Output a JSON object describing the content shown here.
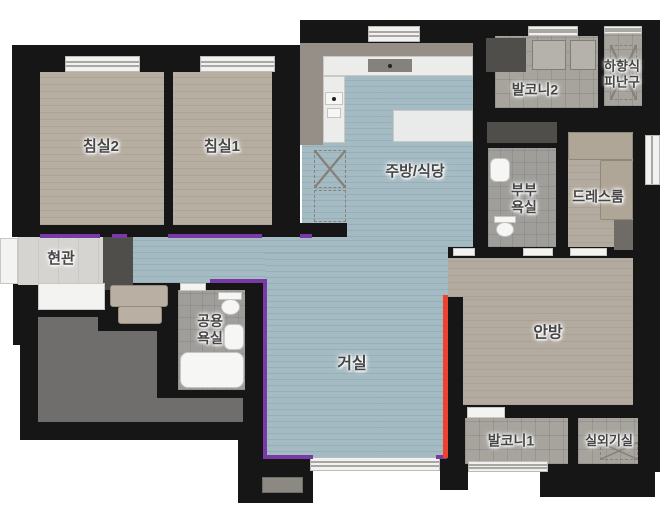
{
  "plan": {
    "type": "apartment-floor-plan",
    "rooms": {
      "bedroom2": {
        "label": "침실2"
      },
      "bedroom1": {
        "label": "침실1"
      },
      "kitchen_dining": {
        "label": "주방/식당"
      },
      "balcony2": {
        "label": "발코니2"
      },
      "escape_hatch": {
        "line1": "하향식",
        "line2": "피난구"
      },
      "master_bathroom": {
        "line1": "부부",
        "line2": "욕실"
      },
      "dress_room": {
        "label": "드레스룸"
      },
      "entrance": {
        "label": "현관"
      },
      "shared_bathroom": {
        "line1": "공용",
        "line2": "욕실"
      },
      "living_room": {
        "label": "거실"
      },
      "master_bedroom": {
        "label": "안방"
      },
      "balcony1": {
        "label": "발코니1"
      },
      "outdoor_unit_room": {
        "label": "실외기실"
      }
    },
    "colors": {
      "wall": "#161616",
      "floor_wood": "#b7aea2",
      "floor_blue": "#a5bbc3",
      "floor_tile": "#a7a49e",
      "entrance_tile": "#d6d4d0",
      "core_gray": "#6f6e6c",
      "counter_white": "#ececea",
      "accent_purple": "#7a3aa5",
      "accent_red": "#ee4230"
    }
  }
}
